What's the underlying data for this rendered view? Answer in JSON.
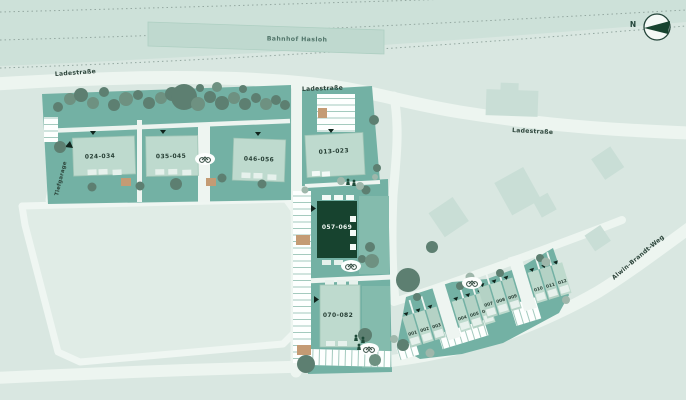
{
  "station": {
    "label": "Bahnhof Hasloh"
  },
  "compass": {
    "north": "N"
  },
  "streets": {
    "ladestrasse_west": "Ladestraße",
    "ladestrasse_mid": "Ladestraße",
    "ladestrasse_east": "Ladestraße",
    "alwin_brandt_weg": "Alwin-Brandt-Weg",
    "tiefgarage_ramp": "Tiefgarage"
  },
  "buildings": [
    {
      "id": "024-034",
      "label": "024-034",
      "selected": false
    },
    {
      "id": "035-045",
      "label": "035-045",
      "selected": false
    },
    {
      "id": "046-056",
      "label": "046-056",
      "selected": false
    },
    {
      "id": "013-023",
      "label": "013-023",
      "selected": false
    },
    {
      "id": "057-069",
      "label": "057-069",
      "selected": true
    },
    {
      "id": "070-082",
      "label": "070-082",
      "selected": false
    }
  ],
  "houses": [
    "001",
    "002",
    "003",
    "004",
    "005",
    "006",
    "007",
    "008",
    "009",
    "010",
    "011",
    "012"
  ],
  "colors": {
    "background": "#d9e7e1",
    "rail_corridor": "#cde1d9",
    "parcel": "#73b1a4",
    "building": "#bedace",
    "selected_building": "#17432f",
    "road": "#edf5f0",
    "tree": "#5d7f71",
    "utility_tan": "#c49b74"
  }
}
